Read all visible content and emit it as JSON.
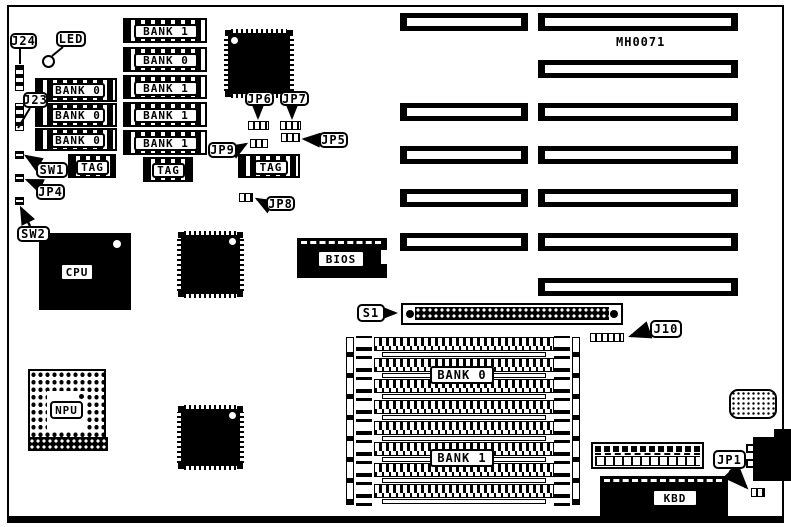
{
  "board": {
    "part_number": "MH0071",
    "colors": {
      "foreground": "#000000",
      "background": "#ffffff"
    }
  },
  "callouts": {
    "j24": "J24",
    "led": "LED",
    "j23": "J23",
    "sw1": "SW1",
    "jp4": "JP4",
    "sw2": "SW2",
    "jp6": "JP6",
    "jp7": "JP7",
    "jp9": "JP9",
    "jp5": "JP5",
    "jp8": "JP8",
    "s1": "S1",
    "j10": "J10",
    "jp1": "JP1"
  },
  "chips": {
    "cpu": "CPU",
    "npu": "NPU",
    "bios": "BIOS",
    "kbd": "KBD"
  },
  "memory": {
    "left_column_banks": [
      "BANK 0",
      "BANK 0",
      "BANK 0"
    ],
    "middle_column_banks": [
      "BANK 1",
      "BANK 0",
      "BANK 1",
      "BANK 1",
      "BANK 1"
    ],
    "tag_sockets": [
      "TAG",
      "TAG",
      "TAG"
    ],
    "simm_array_banks": [
      "BANK 0",
      "BANK 1"
    ]
  }
}
